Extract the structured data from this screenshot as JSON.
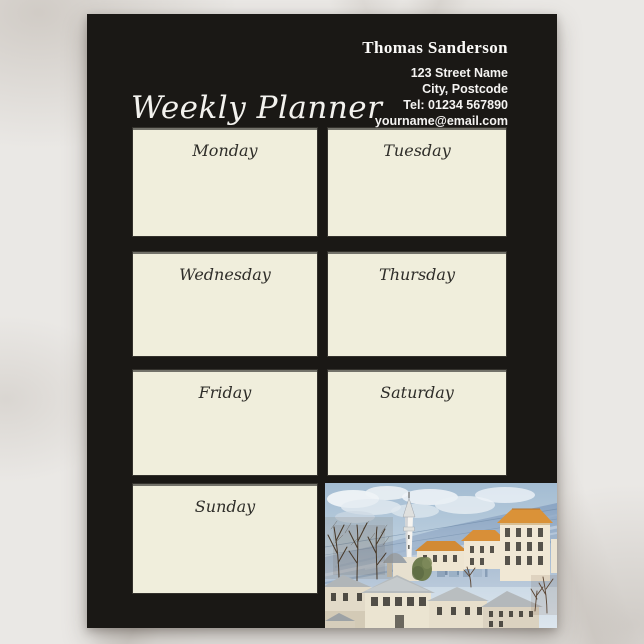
{
  "title": "Weekly Planner",
  "contact": {
    "name": "Thomas Sanderson",
    "address_lines": [
      "123 Street Name",
      "City, Postcode",
      "Tel: 01234 567890",
      "yourname@email.com"
    ]
  },
  "days": [
    "Monday",
    "Tuesday",
    "Wednesday",
    "Thursday",
    "Friday",
    "Saturday",
    "Sunday"
  ],
  "artwork": "watercolor-townscape-with-minaret-and-orange-rooftops",
  "colors": {
    "page_background": "#1a1815",
    "note_box": "#f0eedc",
    "header_text": "#ffffff",
    "day_text": "#2e2d29",
    "marble_surface": "#eae8e5"
  }
}
